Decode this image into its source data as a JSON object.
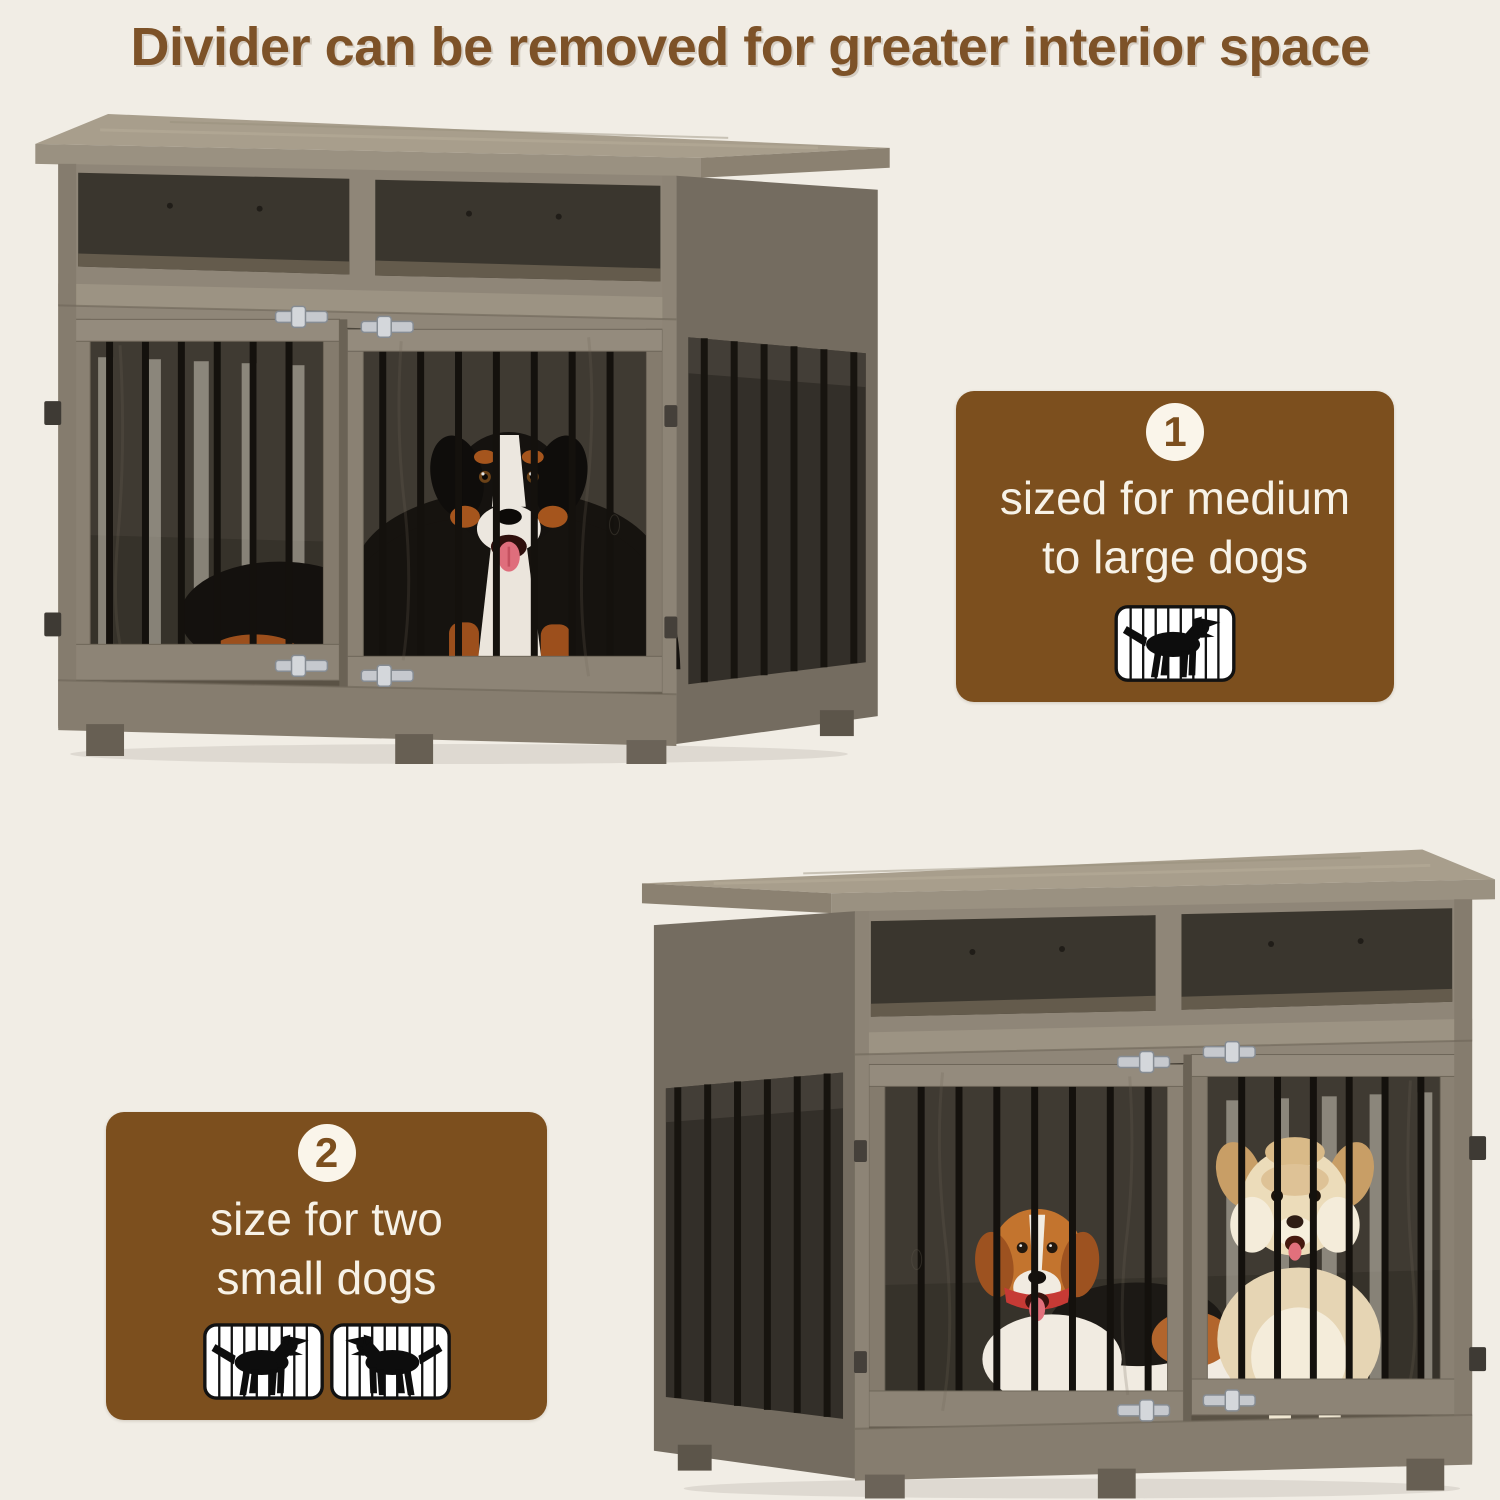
{
  "background_color": "#f1ede5",
  "title": {
    "text": "Divider can be removed for greater interior space",
    "color": "#7d5228"
  },
  "callouts": [
    {
      "number": "1",
      "lines": [
        "sized for medium",
        "to large dogs"
      ],
      "icon": "dog-in-crate-icon",
      "background": "#7c4f1e",
      "text_color": "#f7f2e7"
    },
    {
      "number": "2",
      "lines": [
        "size for two",
        "small dogs"
      ],
      "icon": "two-dogs-in-crates-icon",
      "background": "#7c4f1e",
      "text_color": "#f7f2e7"
    }
  ],
  "photos": [
    {
      "name": "crate-divider-removed-one-large-dog",
      "dog": "bernese-mountain-dog"
    },
    {
      "name": "crate-with-divider-two-small-dogs",
      "dogs": [
        "beagle",
        "small-fluffy-dog"
      ]
    }
  ],
  "palette": {
    "wood_light": "#a89e8c",
    "wood_mid": "#8f8678",
    "wood_side": "#746c60",
    "interior_dark": "#3a362e",
    "bars": "#15120e",
    "metal": "#c6c9ce"
  }
}
